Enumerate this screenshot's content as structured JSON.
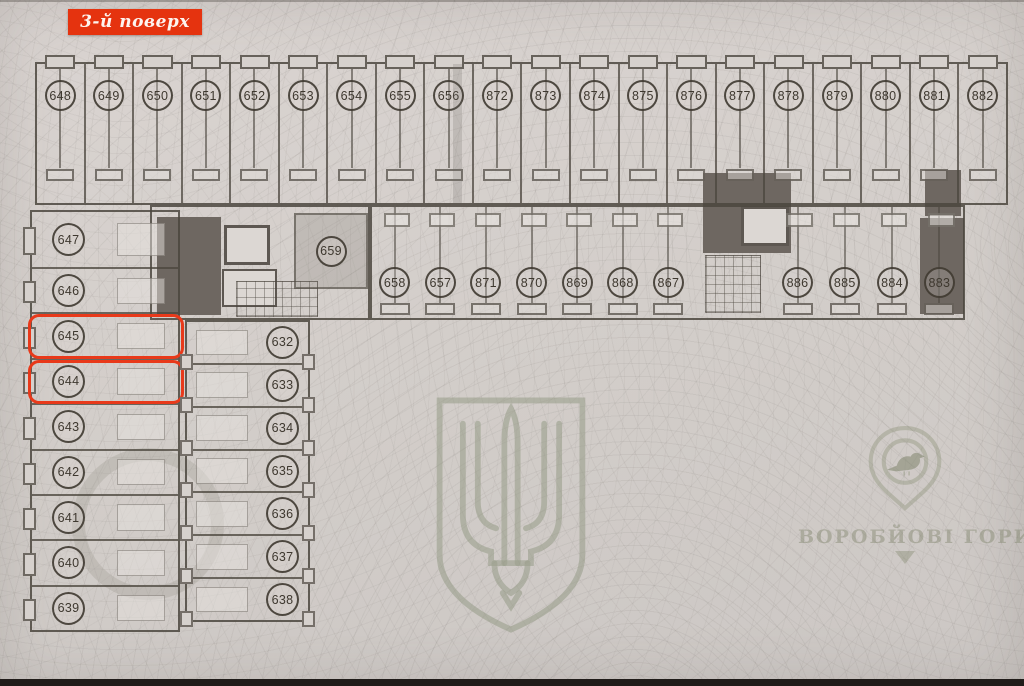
{
  "floor_label": "3-й поверх",
  "logo_text": "ВОРОБЙОВІ ГОРИ",
  "highlighted": [
    "645",
    "644"
  ],
  "rooms": {
    "top_row": [
      "648",
      "649",
      "650",
      "651",
      "652",
      "653",
      "654",
      "655",
      "656",
      "872",
      "873",
      "874",
      "875",
      "876",
      "877",
      "878",
      "879",
      "880",
      "881",
      "882"
    ],
    "second_row_main": [
      "658",
      "657",
      "871",
      "870",
      "869",
      "868",
      "867"
    ],
    "second_row_right": [
      "886",
      "885",
      "884",
      "883"
    ],
    "center_room": "659",
    "left_column": [
      "647",
      "646",
      "645",
      "644",
      "643",
      "642",
      "641",
      "640",
      "639"
    ],
    "middle_column": [
      "632",
      "633",
      "634",
      "635",
      "636",
      "637",
      "638"
    ]
  },
  "colors": {
    "highlight_red": "#e8391a",
    "label_background": "#e5330f",
    "paper": "#d3cecb",
    "ink": "#4b463e",
    "dark_fill": "#6e6761",
    "watermark_green": "#9aa08f"
  }
}
